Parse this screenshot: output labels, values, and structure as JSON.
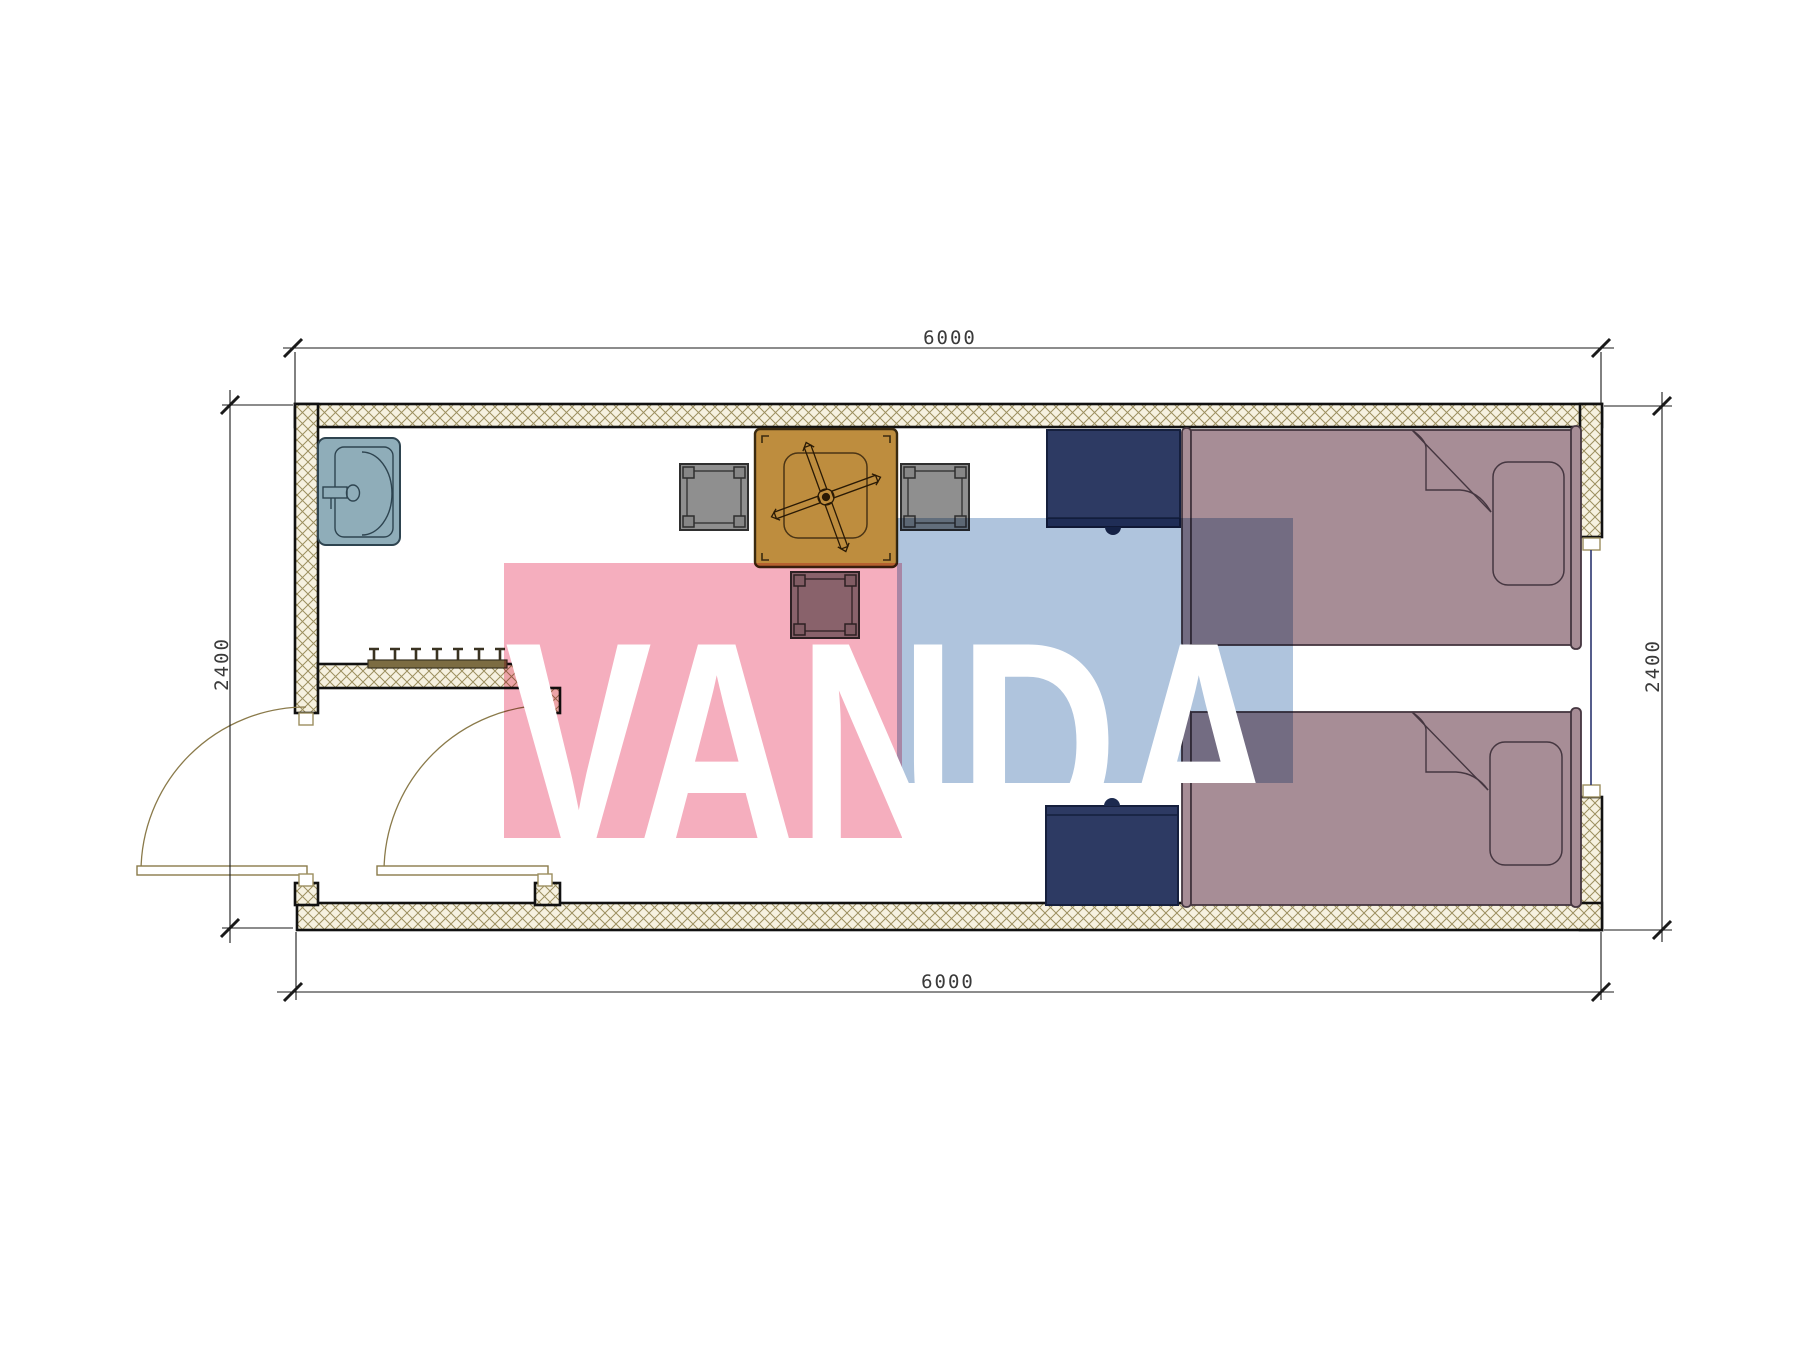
{
  "drawing": {
    "type": "architectural-floor-plan",
    "dimension_labels": {
      "top": "6000",
      "bottom": "6000",
      "left": "2400",
      "right": "2400"
    },
    "watermark": {
      "text": "VANDA",
      "pink_color": "#F5AEBE",
      "blue_color": "#AFC4DD",
      "text_color": "#FFFFFF"
    },
    "symbols": [
      "sink",
      "coat-rack",
      "table",
      "ceiling-fan",
      "stool-left",
      "stool-right",
      "stool-bottom",
      "nightstand-top",
      "nightstand-bottom",
      "bed-top",
      "bed-bottom",
      "door-west",
      "door-inner",
      "window-east"
    ],
    "colors": {
      "wall_hatch_fill": "#F6F1E0",
      "wall_hatch_line": "#9C8F5F",
      "wall_outline": "#111111",
      "sink_fill": "#8FADB9",
      "sink_stroke": "#2E4450",
      "table_fill": "#BE8D3E",
      "stool_fill": "#8F8F8F",
      "nightstand_fill": "#2D3A63",
      "bed_fill": "#A78D96",
      "bed_stroke": "#453640",
      "door_arc": "#8A7A4A",
      "window_glass": "#2B3570",
      "dimension_line": "#1a1a1a"
    }
  }
}
